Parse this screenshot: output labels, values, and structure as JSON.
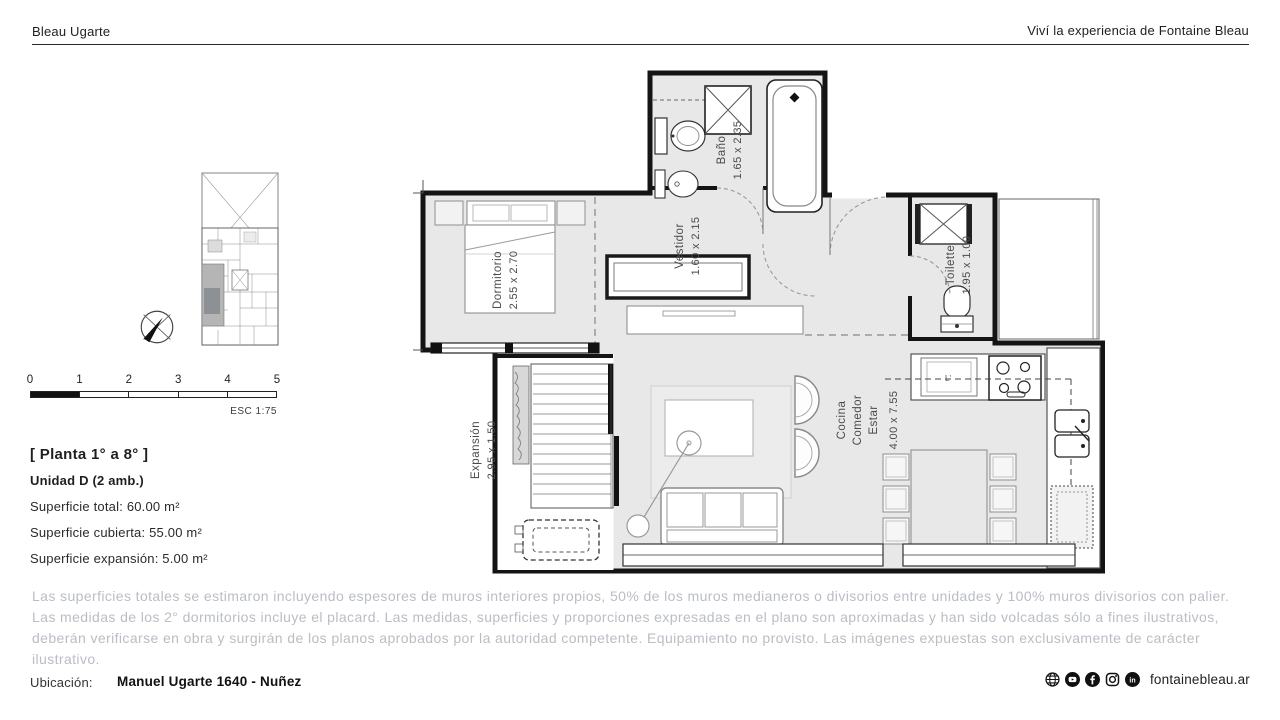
{
  "header": {
    "brand": "Bleau Ugarte",
    "tagline": "Viví la experiencia de Fontaine Bleau"
  },
  "scalebar": {
    "ticks": [
      "0",
      "1",
      "2",
      "3",
      "4",
      "5"
    ],
    "esc": "ESC 1:75"
  },
  "info": {
    "planta": "[ Planta 1° a 8° ]",
    "unidad": "Unidad D (2 amb.)",
    "sup_total": "Superficie total: 60.00 m²",
    "sup_cubierta": "Superficie cubierta: 55.00 m²",
    "sup_expansion": "Superficie expansión: 5.00 m²"
  },
  "plan": {
    "banio_name": "Baño",
    "banio_dims": "1.65 x 2.35",
    "vestidor_name": "Vestidor",
    "vestidor_dims": "1.60 x 2.15",
    "dormitorio_name": "Dormitorio",
    "dormitorio_dims": "2.55 x 2.70",
    "toilette_name": "Toilette",
    "toilette_dims": "1.95 x 1.00",
    "cocina_line1": "Cocina",
    "cocina_line2": "Comedor",
    "cocina_line3": "Estar",
    "cocina_dims": "4.00 x 7.55",
    "expansion_name": "Expansión",
    "expansion_dims": "2.95 x 1.50",
    "kitchen_mark": "L'"
  },
  "disclaimer": "Las superficies totales se estimaron incluyendo espesores de muros interiores propios, 50% de los muros medianeros o divisorios entre unidades y 100% muros divisorios con palier. Las medidas de los 2° dormitorios incluye el placard. Las medidas, superficies y proporciones expresadas en el plano son aproximadas y han sido volcadas sólo a fines ilustrativos, deberán verificarse en obra y surgirán de los planos aprobados por la autoridad competente. Equipamiento no provisto. Las imágenes expuestas son exclusivamente de carácter ilustrativo.",
  "footer": {
    "ubicacion_label": "Ubicación:",
    "address": "Manuel Ugarte 1640 - Nuñez",
    "website": "fontainebleau.ar",
    "icons": [
      "website",
      "youtube",
      "facebook",
      "instagram",
      "linkedin"
    ]
  },
  "colors": {
    "text_dark": "#1f1f1f",
    "text_muted": "#b9bdc4",
    "wall": "#141414",
    "floor": "#e8e8e8"
  }
}
